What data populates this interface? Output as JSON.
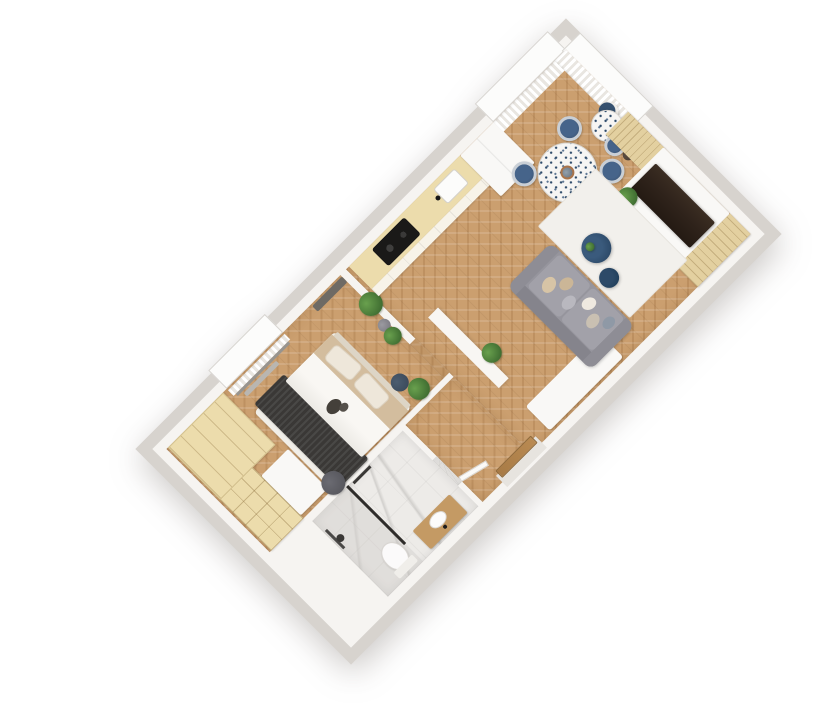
{
  "scene": {
    "type": "3d-floor-plan-render",
    "view": "top-down",
    "rotation_deg": -45,
    "background": "#ffffff"
  },
  "canvas": {
    "width": 827,
    "height": 726
  },
  "plan_geometry": {
    "width": 585,
    "height": 281,
    "center_x": 458,
    "center_y": 342,
    "outer_wall_px": 12
  },
  "rooms": [
    {
      "id": "bedroom",
      "floor": "herringbone-oak",
      "furniture": [
        "double-bed",
        "dark-knit-throw",
        "white-duvet",
        "beige-sheet",
        "two-pillows",
        "headboard",
        "beige-wardrobe",
        "open-shelving-unit",
        "white-desk-bench",
        "round-gray-pouf",
        "navy-pouf",
        "potted-plant",
        "window-with-curtain",
        "wall-shelf"
      ]
    },
    {
      "id": "bathroom",
      "floor": "white-marble",
      "furniture": [
        "walk-in-shower",
        "black-glass-partition",
        "black-shower-fixture",
        "toilet",
        "wood-vanity",
        "white-basin",
        "black-faucet",
        "towel-bar",
        "door-leaf"
      ]
    },
    {
      "id": "hallway",
      "floor": "herringbone-oak",
      "furniture": [
        "entrance-door",
        "white-console",
        "half-wall",
        "potted-plant",
        "plant-cluster"
      ]
    },
    {
      "id": "kitchen",
      "floor": "herringbone-oak",
      "furniture": [
        "beige-counter",
        "black-cooktop",
        "white-sink",
        "black-faucet",
        "tall-white-cabinet"
      ]
    },
    {
      "id": "living-room",
      "floor": "herringbone-oak",
      "furniture": [
        "round-dining-table-terrazzo",
        "table-vase",
        "four-navy-chairs",
        "bistro-table-terrazzo",
        "navy-armchair",
        "white-shell-chair",
        "dark-stool",
        "gray-sofa",
        "sofa-pillows",
        "white-area-rug",
        "navy-coffee-table-large",
        "navy-coffee-table-small",
        "rug-plant",
        "media-console",
        "dark-tv-unit",
        "slatted-sideboard",
        "corner-slatted-shelf",
        "console-plant",
        "curtained-windows"
      ]
    }
  ],
  "colors": {
    "wall_outer": "#d7d3ce",
    "wall_inner": "#f6f4f1",
    "wood": "#cb9f6f",
    "beige": "#ecdcac",
    "beige_dark": "#e3d0a0",
    "marble": "#edebe8",
    "marble_vein": "#d2d0cd",
    "white_furn": "#f9f8f6",
    "sofa": "#96959d",
    "sofa_dark": "#85848c",
    "rug": "#f2f0ec",
    "navy": "#2d4a69",
    "navy_dark": "#22405c",
    "tv": "#2f231b",
    "plant": "#3f6d31",
    "plant_light": "#69a04e",
    "throw": "#3a3836",
    "sheet": "#d3bd9e",
    "vanity": "#c49a64",
    "pouf": "#57575d",
    "fixture": "#3a3836",
    "curtain": "#e9e6e1",
    "entry_door": "#b98a52"
  }
}
